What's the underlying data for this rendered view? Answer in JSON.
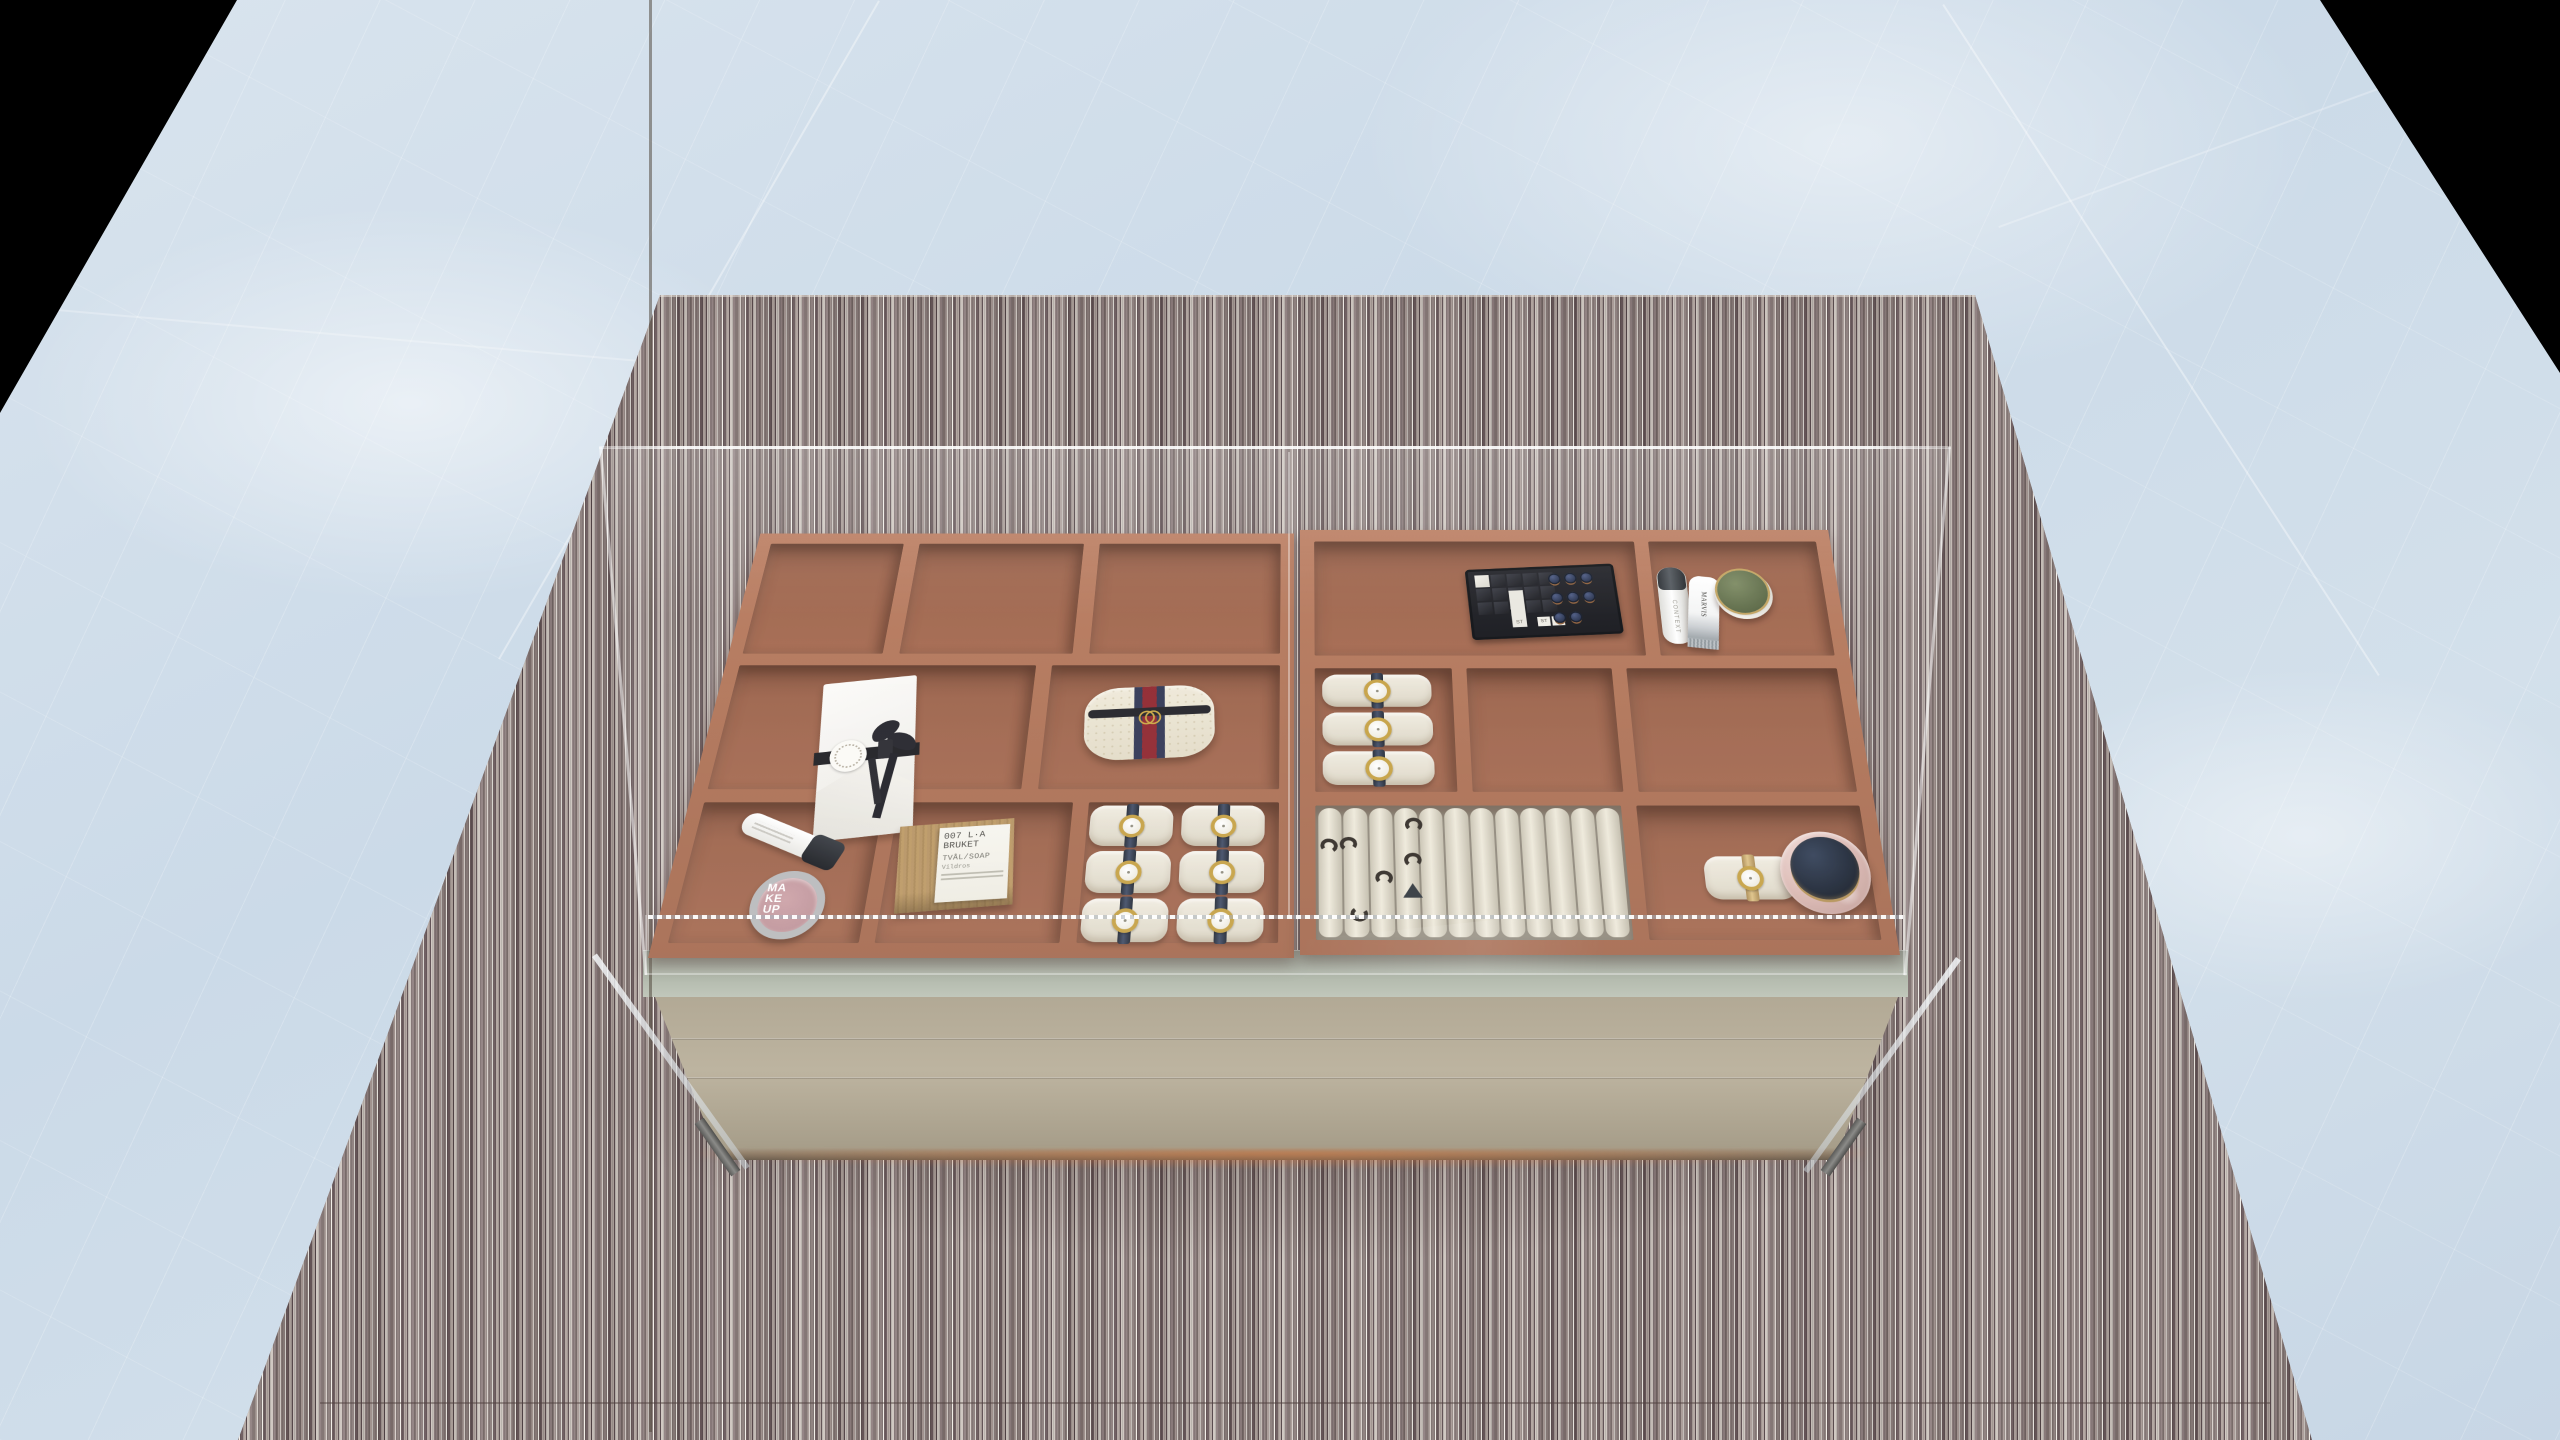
{
  "scene": {
    "description": "3D interior render, top-front view of a glass-top jewelry display dresser with two terracotta compartment trays, standing on a striped rug over light-blue marble tile floor",
    "background_color": "#000000",
    "floor": {
      "material": "blue-grey marble tiles",
      "base_color": "#cfdde9",
      "vein_color": "#eef3f8"
    },
    "rug": {
      "material": "striped fabric rug",
      "base_color": "#998b88",
      "dark_stripe": "#5c4c4f",
      "light_stripe": "#d6cfc9",
      "highlight": "#f1ede7"
    },
    "cabinet": {
      "body_color": "#b8af9a",
      "shelf_color": "#aab1a4",
      "tray_color": "#a2654b",
      "glass_tint": "rgba(255,255,255,0.10)",
      "drawer_columns": 2,
      "drawer_rows": 3,
      "leg_count": 4,
      "underglow_color": "#e07a3e"
    }
  },
  "items": {
    "envelope": {
      "label": "white gift envelope with black ribbon bow and round seal sticker"
    },
    "tube": {
      "label": "white cosmetic tube with dark cap"
    },
    "makeup_jar": {
      "label": "makeup jar, silver rim and pink lid",
      "line1": "MA",
      "line2": "KE",
      "line3": "UP"
    },
    "soap_box": {
      "label": "kraft soap box",
      "line1": "007 L·A BRUKET",
      "line2": "TVÅL/SOAP",
      "line3": "Vildros"
    },
    "pouch": {
      "label": "cream monogram pouch with navy-red web stripe and gold GG logo"
    },
    "watch_pillows_left": {
      "label": "watch pillows with gold watches on navy straps",
      "count": 6
    },
    "lipstick_tray": {
      "label": "black lipstick organizer",
      "lipstick_count": 8,
      "tag1": "ST",
      "tag2": "ST",
      "tag3": "ST"
    },
    "bottle": {
      "label": "white cylindrical bottle with dark cap",
      "text": "CONTEXT"
    },
    "toothpaste": {
      "label": "toothpaste tube",
      "text": "MARVIS"
    },
    "cream_jar": {
      "label": "white jar with olive-green lid and gold ring"
    },
    "watch_pillows_right": {
      "label": "watch pillows with gold watches on navy straps",
      "count": 3
    },
    "ring_tray": {
      "label": "cream ring roll tray",
      "roll_count": 12,
      "ring_count": 7
    },
    "gold_watch_pillow": {
      "label": "watch pillow with gold mesh watch"
    },
    "marble_dish": {
      "label": "pink marble dish with dark navy lid and gold ring"
    }
  }
}
